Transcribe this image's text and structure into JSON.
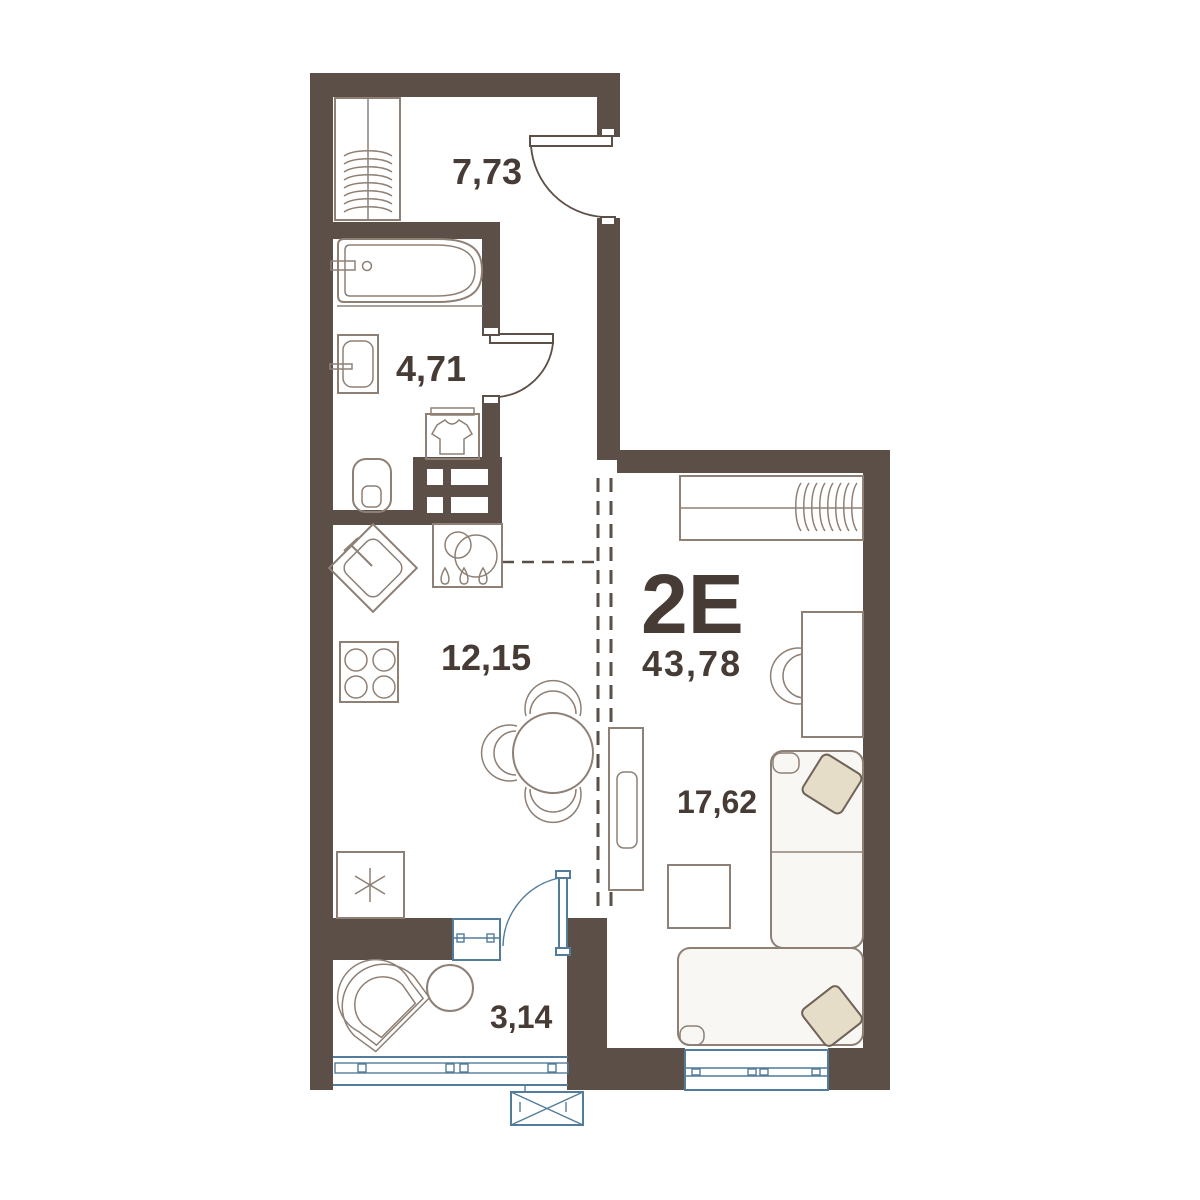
{
  "plan": {
    "unit_label": "2Е",
    "total_area": "43,78",
    "rooms": [
      {
        "name": "hallway",
        "area": "7,73"
      },
      {
        "name": "bathroom",
        "area": "4,71"
      },
      {
        "name": "kitchen-dining",
        "area": "12,15"
      },
      {
        "name": "living-room",
        "area": "17,62"
      },
      {
        "name": "balcony",
        "area": "3,14"
      }
    ],
    "furniture_symbols": [
      "wardrobe-with-hangers",
      "bathtub",
      "washbasin",
      "toilet",
      "washing-machine",
      "ventilation-shaft",
      "kitchen-sink",
      "dishwasher",
      "stove",
      "refrigerator",
      "dining-table-with-chairs",
      "tv-stand",
      "wardrobe-living",
      "desk",
      "desk-chair",
      "corner-sofa",
      "pillows",
      "coffee-table",
      "lounge-chair",
      "side-table",
      "air-conditioner",
      "entrance-door",
      "bathroom-door",
      "balcony-door",
      "window",
      "balcony-glazing"
    ],
    "colors": {
      "walls": "#5b4f47",
      "furniture_outline": "#8e8075",
      "glazing_blue": "#527c99",
      "text": "#463b35",
      "pillow_fill": "#e6ddc8",
      "background": "#ffffff"
    }
  }
}
